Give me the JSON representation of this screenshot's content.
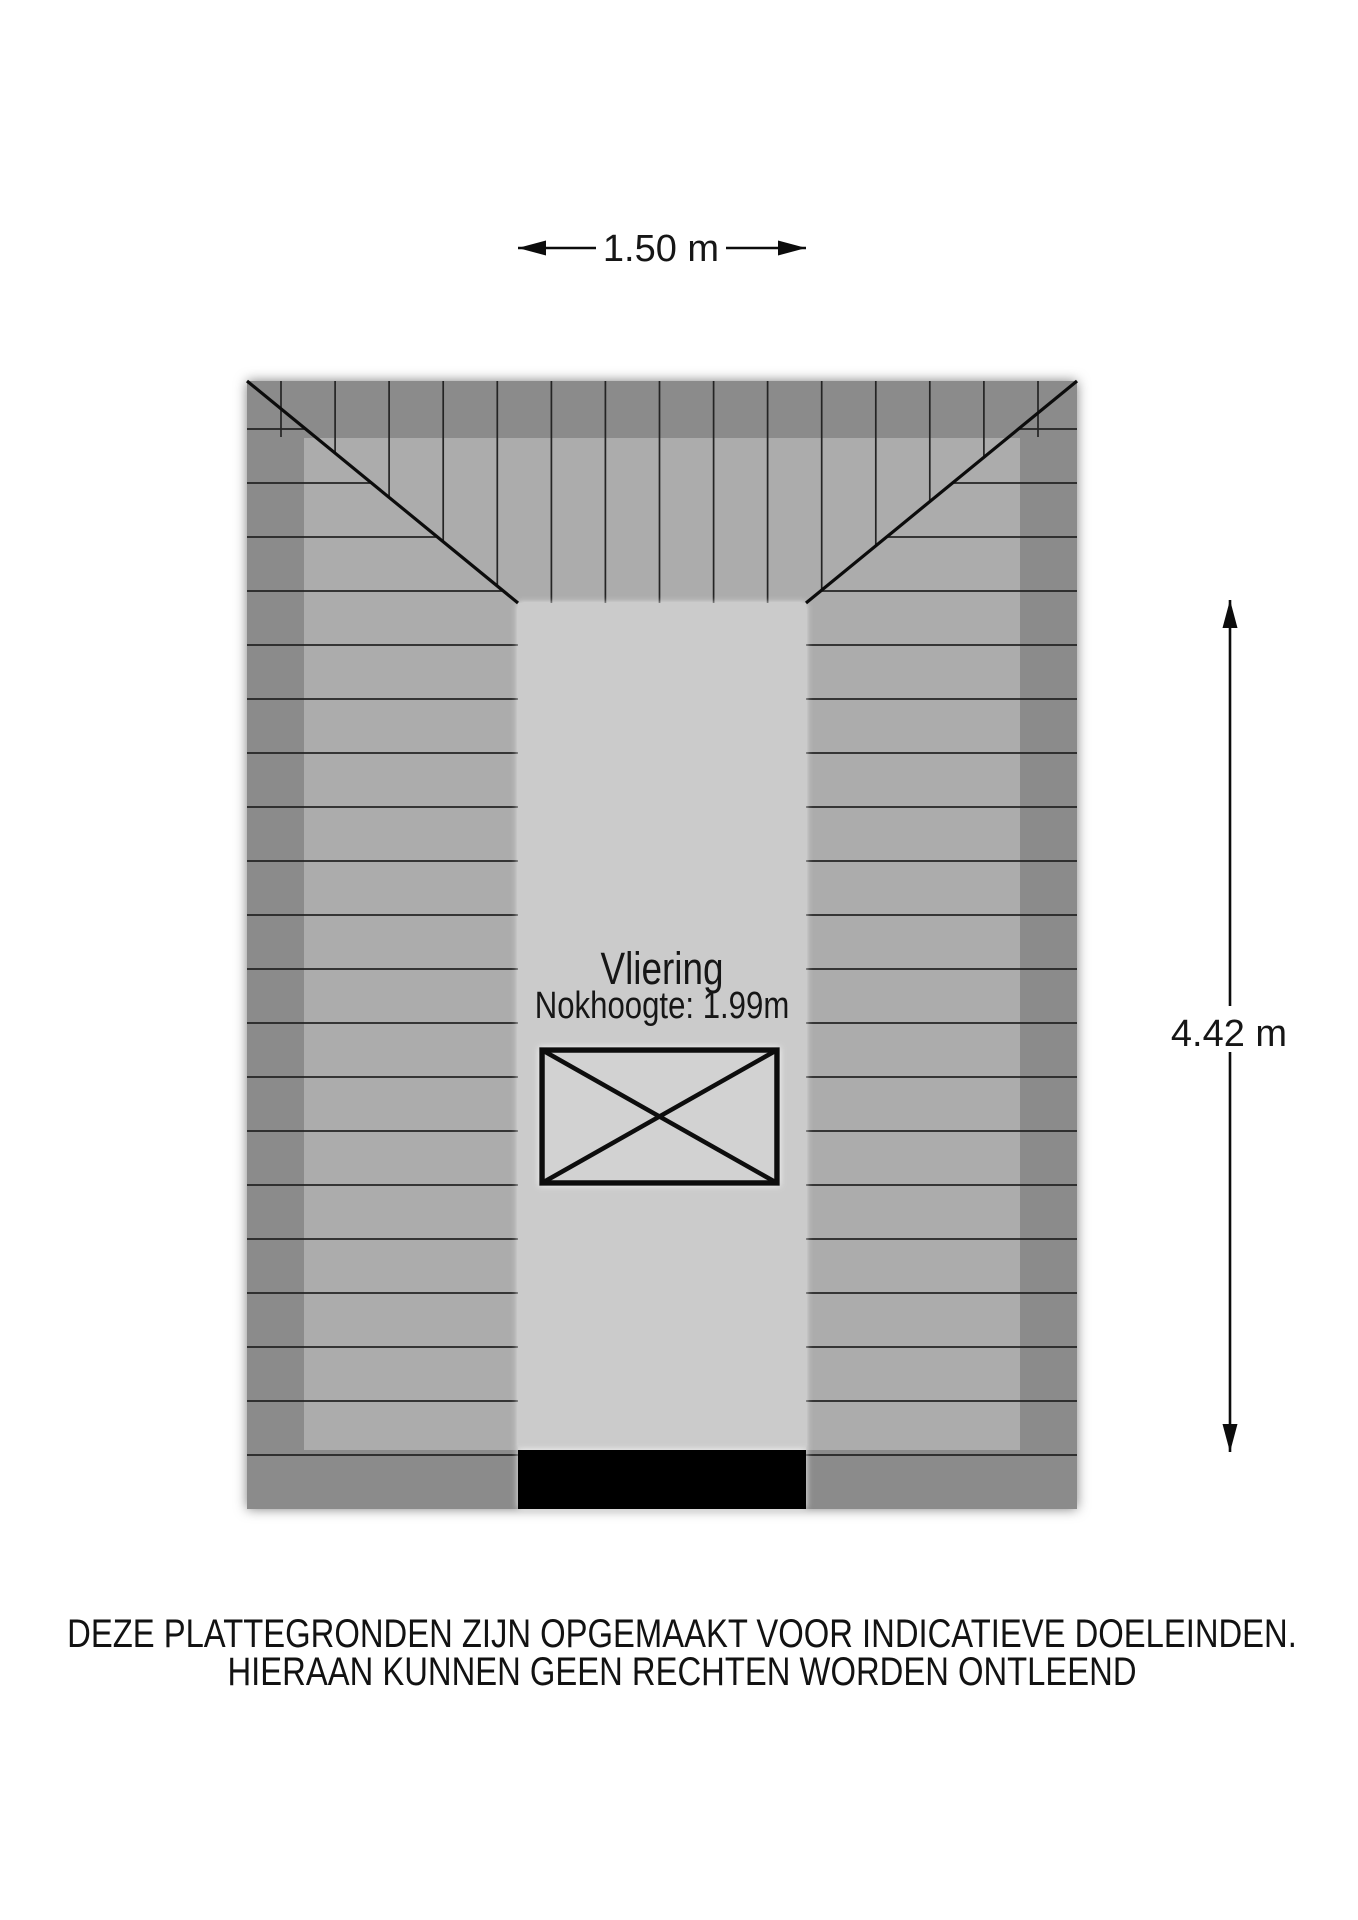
{
  "floorplan": {
    "room": {
      "name": "Vliering",
      "detail": "Nokhoogte: 1.99m"
    },
    "dimensions": {
      "width_label": "1.50 m",
      "height_label": "4.42 m"
    }
  },
  "footer": {
    "line1": "DEZE PLATTEGRONDEN ZIJN OPGEMAAKT VOOR INDICATIEVE DOELEINDEN.",
    "line2": "HIERAAN KUNNEN GEEN RECHTEN WORDEN ONTLEEND"
  },
  "colors": {
    "background": "#ffffff",
    "roof_outer": "#8b8b8b",
    "roof_inner": "#acacac",
    "floor_light": "#cbcbcb",
    "void_fill": "#d2d2d2",
    "solid_black": "#000000",
    "line_dark": "#161616"
  }
}
